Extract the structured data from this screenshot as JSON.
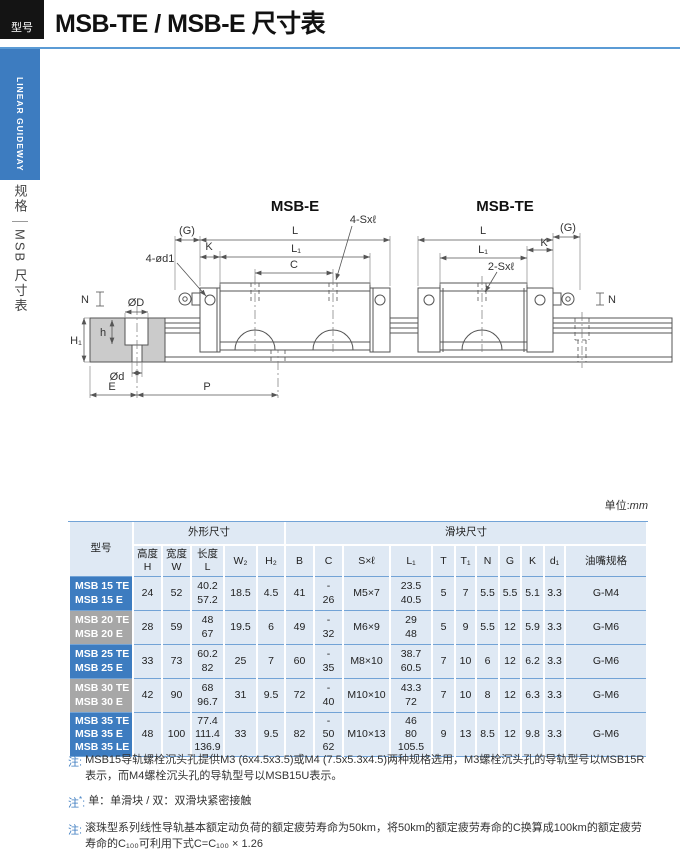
{
  "header": {
    "badge": "型号",
    "title": "MSB-TE / MSB-E 尺寸表"
  },
  "sidebar": {
    "vertical_label": "LINEAR GUIDEWAY",
    "section": "规格",
    "subsection": "MSB 尺寸表"
  },
  "diagram": {
    "msb_e": {
      "title": "MSB-E",
      "dim_g": "(G)",
      "dim_k": "K",
      "dim_l": "L",
      "dim_l1": "L₁",
      "dim_c": "C",
      "dim_sxl": "4-Sxℓ",
      "dim_od1": "4-ød1",
      "dim_n": "N"
    },
    "msb_te": {
      "title": "MSB-TE",
      "dim_l": "L",
      "dim_l1": "L₁",
      "dim_k": "K",
      "dim_g": "(G)",
      "dim_sxl": "2-Sxℓ",
      "dim_n": "N"
    },
    "section": {
      "dim_od_top": "ØD",
      "dim_h": "h",
      "dim_h1": "H₁",
      "dim_od_bottom": "Ød",
      "dim_e": "E",
      "dim_p": "P"
    }
  },
  "unit": {
    "label": "单位:",
    "value": "mm"
  },
  "table": {
    "col_model": "型号",
    "group_outer": "外形尺寸",
    "group_block": "滑块尺寸",
    "headers": [
      "高度\nH",
      "宽度\nW",
      "长度\nL",
      "W₂",
      "H₂",
      "B",
      "C",
      "S×ℓ",
      "L₁",
      "T",
      "T₁",
      "N",
      "G",
      "K",
      "d₁",
      "油嘴规格"
    ],
    "rows": [
      {
        "model": "MSB 15 TE\nMSB 15 E",
        "color": "#3d7cc0",
        "values": [
          "24",
          "52",
          "40.2\n57.2",
          "18.5",
          "4.5",
          "41",
          "-\n26",
          "M5×7",
          "23.5\n40.5",
          "5",
          "7",
          "5.5",
          "5.5",
          "5.1",
          "3.3",
          "G-M4"
        ]
      },
      {
        "model": "MSB 20 TE\nMSB 20 E",
        "color": "#a7a7a7",
        "values": [
          "28",
          "59",
          "48\n67",
          "19.5",
          "6",
          "49",
          "-\n32",
          "M6×9",
          "29\n48",
          "5",
          "9",
          "5.5",
          "12",
          "5.9",
          "3.3",
          "G-M6"
        ]
      },
      {
        "model": "MSB 25 TE\nMSB 25 E",
        "color": "#3d7cc0",
        "values": [
          "33",
          "73",
          "60.2\n82",
          "25",
          "7",
          "60",
          "-\n35",
          "M8×10",
          "38.7\n60.5",
          "7",
          "10",
          "6",
          "12",
          "6.2",
          "3.3",
          "G-M6"
        ]
      },
      {
        "model": "MSB 30 TE\nMSB 30 E",
        "color": "#a7a7a7",
        "values": [
          "42",
          "90",
          "68\n96.7",
          "31",
          "9.5",
          "72",
          "-\n40",
          "M10×10",
          "43.3\n72",
          "7",
          "10",
          "8",
          "12",
          "6.3",
          "3.3",
          "G-M6"
        ]
      },
      {
        "model": "MSB 35 TE\nMSB 35 E\nMSB 35 LE",
        "color": "#3d7cc0",
        "values": [
          "48",
          "100",
          "77.4\n111.4\n136.9",
          "33",
          "9.5",
          "82",
          "-\n50\n62",
          "M10×13",
          "46\n80\n105.5",
          "9",
          "13",
          "8.5",
          "12",
          "9.8",
          "3.3",
          "G-M6"
        ]
      }
    ]
  },
  "notes": [
    {
      "prefix": "注",
      "sup": "",
      "colon": ":",
      "text": "MSB15导轨螺栓沉头孔提供M3 (6x4.5x3.5)或M4 (7.5x5.3x4.5)两种规格选用，M3螺栓沉头孔的导轨型号以MSB15R表示，而M4螺栓沉头孔的导轨型号以MSB15U表示。"
    },
    {
      "prefix": "注",
      "sup": "*",
      "colon": ":",
      "text": "单：单滑块 / 双：双滑块紧密接触"
    },
    {
      "prefix": "注",
      "sup": "",
      "colon": ":",
      "text": "滚珠型系列线性导轨基本额定动负荷的额定疲劳寿命为50km，将50km的额定疲劳寿命的C换算成100km的额定疲劳寿命的C₁₀₀可利用下式C=C₁₀₀ × 1.26"
    }
  ],
  "colors": {
    "accent_blue": "#3d7cc0",
    "row_gray": "#a7a7a7",
    "cell_bg": "#dfe9f4",
    "rule_blue": "#5b9bd5",
    "line_blue": "#72a3d6"
  }
}
